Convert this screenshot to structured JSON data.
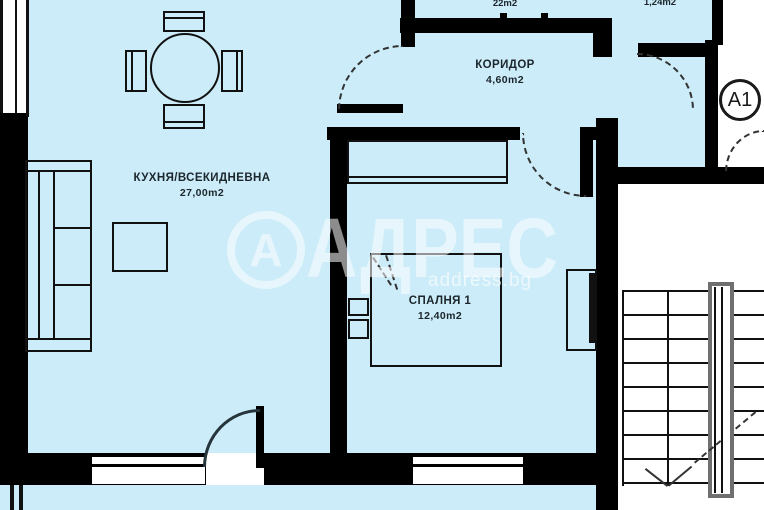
{
  "colors": {
    "floor": "#cbecf8",
    "wall": "#000000",
    "outside": "#ffffff",
    "railing": "#6f6f6f"
  },
  "rooms": {
    "kitchen": {
      "name": "КУХНЯ/ВСЕКИДНЕВНА",
      "area": "27,00m2"
    },
    "corridor": {
      "name": "КОРИДОР",
      "area": "4,60m2"
    },
    "bedroom": {
      "name": "СПАЛНЯ 1",
      "area": "12,40m2"
    },
    "top_left": {
      "area": "22m2"
    },
    "top_right": {
      "area": "1,24m2"
    }
  },
  "badge": {
    "label": "A1"
  },
  "watermark": {
    "logo_letter": "А",
    "brand": "АДРЕС",
    "domain": "address.bg"
  }
}
